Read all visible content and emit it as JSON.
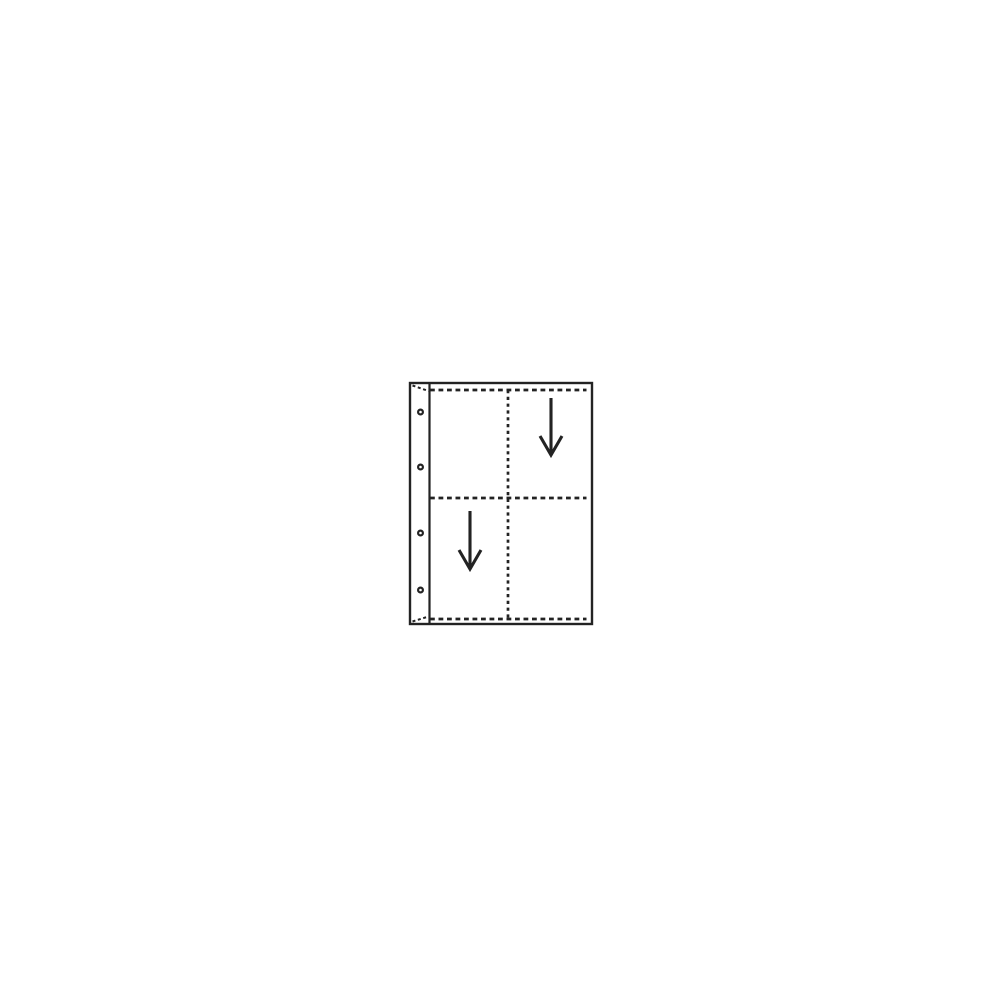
{
  "canvas": {
    "width": 1000,
    "height": 1000,
    "background": "#ffffff"
  },
  "diagram": {
    "kind": "four-pocket-binder-page",
    "ink_color": "#232323",
    "fill_color": "#ffffff",
    "sheet": {
      "x": 410,
      "y": 383,
      "width": 182,
      "height": 241,
      "stroke_width": 2.4
    },
    "binding": {
      "divider_x": 429.5,
      "divider_stroke_width": 2.2,
      "holes": {
        "cx": 420.5,
        "radius": 2.4,
        "stroke_width": 2.2,
        "centers_y": [
          412,
          467,
          533,
          590
        ]
      },
      "corner_seams": {
        "stroke_width": 2,
        "dash": "3 2.6",
        "segments": [
          {
            "x1": 412.5,
            "y1": 385.5,
            "x2": 428.5,
            "y2": 391
          },
          {
            "x1": 412.5,
            "y1": 621.5,
            "x2": 428.5,
            "y2": 616.5
          }
        ]
      }
    },
    "seams": {
      "stroke_width": 2.7,
      "dash_horizontal": "4.8 3.7",
      "dash_vertical": "3.2 3.6",
      "x_start": 430,
      "x_end": 586.5,
      "horizontal_y": [
        390,
        498,
        619
      ],
      "vertical": {
        "x": 508,
        "y1": 390,
        "y2": 619
      }
    },
    "arrows": {
      "stroke_width": 3.1,
      "head_half_width": 11,
      "head_height": 19,
      "shaft_tip_gap": 3,
      "items": [
        {
          "pocket": "top-right",
          "x": 551,
          "y_top": 398,
          "y_tip": 455
        },
        {
          "pocket": "bottom-left",
          "x": 470,
          "y_top": 511,
          "y_tip": 569
        }
      ]
    }
  }
}
